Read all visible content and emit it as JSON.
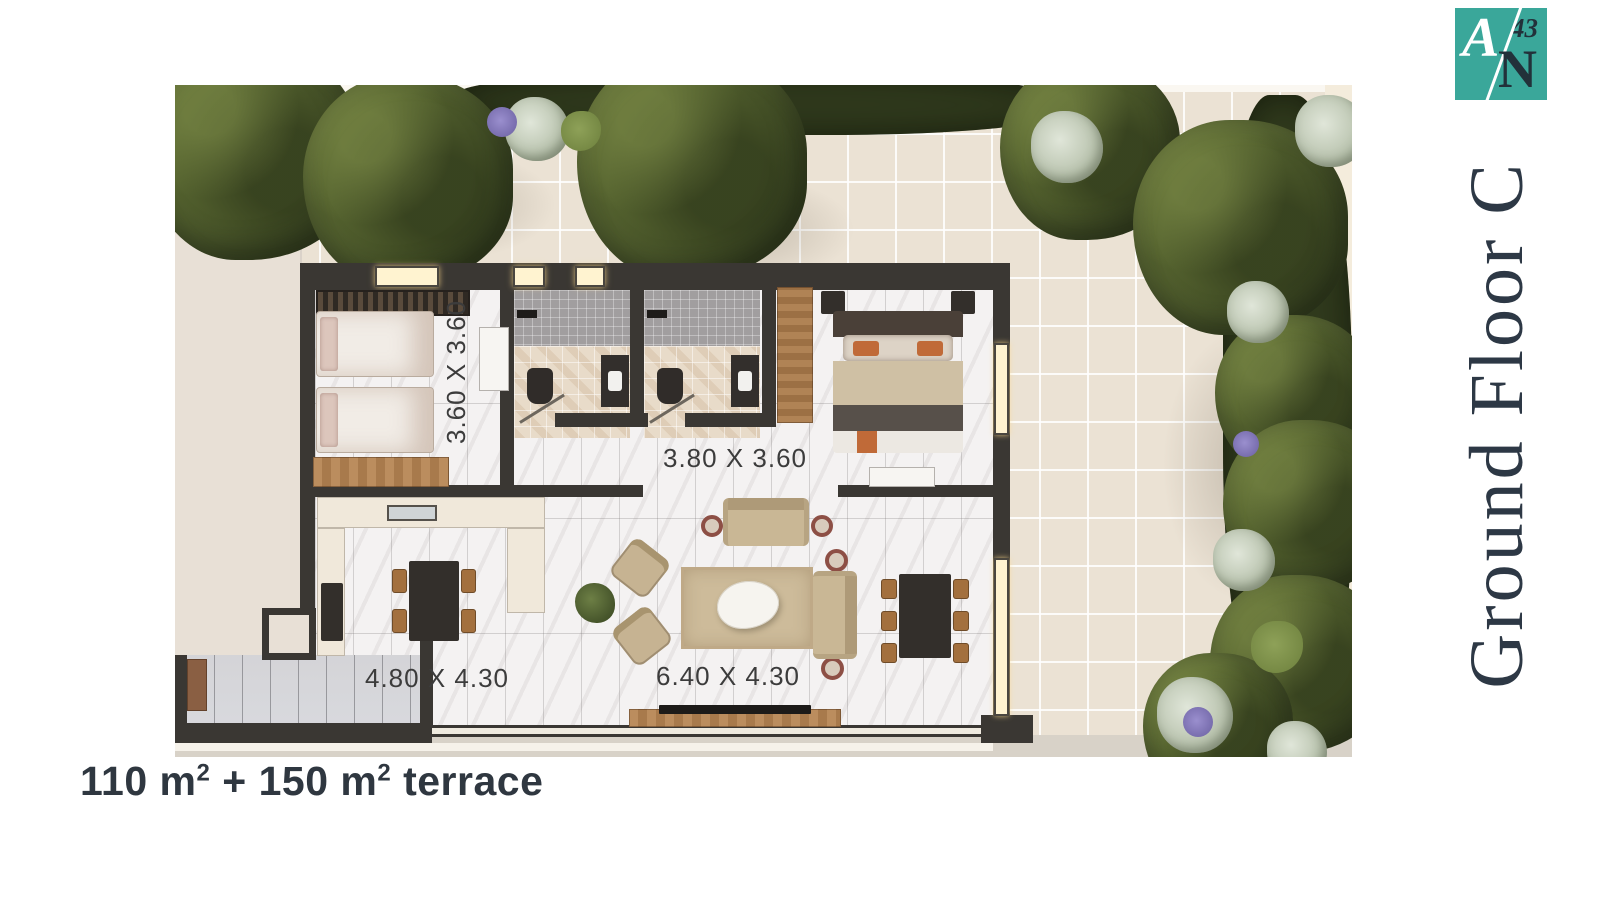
{
  "logo": {
    "letter_a": "A",
    "number": "43",
    "letter_n": "N",
    "bg_color": "#3AA79A",
    "dark_text_color": "#22313A"
  },
  "title": {
    "text": "Ground Floor C",
    "color": "#2D3845"
  },
  "area_caption": {
    "total": "110 m² + 150 m² terrace",
    "part1": "110 m",
    "sup1": "2",
    "part2": " + 150 m",
    "sup2": "2",
    "part3": " terrace"
  },
  "plan": {
    "unit_name": "C",
    "rooms": [
      {
        "name": "bedroom",
        "dimensions": "3.60 X 3.60"
      },
      {
        "name": "hall",
        "dimensions": "3.80 X 3.60"
      },
      {
        "name": "kitchen-dining",
        "dimensions": "4.80 X 4.30"
      },
      {
        "name": "living-room",
        "dimensions": "6.40 X 4.30"
      }
    ],
    "colors": {
      "wall": "#3A3733",
      "terrace_tile": "#EBE2D4",
      "interior_floor": "#F4F2F2",
      "foliage": "#46522A",
      "accent_wood": "#B98A5C",
      "label_text": "#3C3C3C"
    }
  }
}
